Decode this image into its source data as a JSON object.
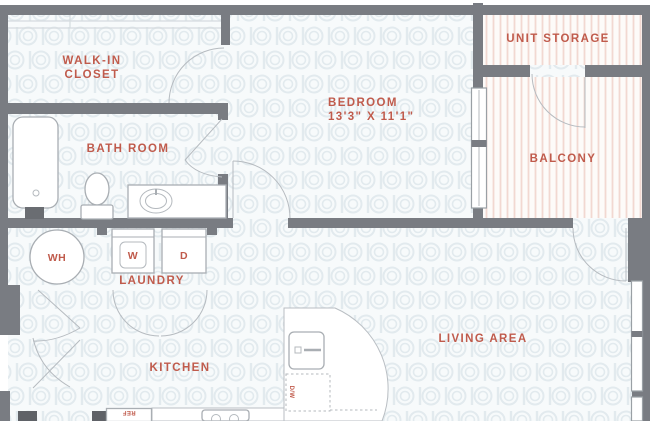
{
  "rooms": {
    "walk_in_closet": {
      "line1": "WALK-IN",
      "line2": "CLOSET"
    },
    "bath_room": {
      "label": "BATH ROOM"
    },
    "bedroom": {
      "label": "BEDROOM",
      "dimensions": "13'3\" X 11'1\""
    },
    "unit_storage": {
      "label": "UNIT STORAGE"
    },
    "balcony": {
      "label": "BALCONY"
    },
    "laundry": {
      "label": "LAUNDRY"
    },
    "kitchen": {
      "label": "KITCHEN"
    },
    "living_area": {
      "label": "LIVING AREA"
    }
  },
  "fixtures": {
    "water_heater": "WH",
    "washer": "W",
    "dryer": "D",
    "refrigerator": "REF",
    "dishwasher": "D/W"
  },
  "colors": {
    "label_red": "#c05b4c",
    "wall_gray": "#797c82",
    "floor_motif": "#e2eaee",
    "balcony_stripe": "#f2d8d1"
  }
}
